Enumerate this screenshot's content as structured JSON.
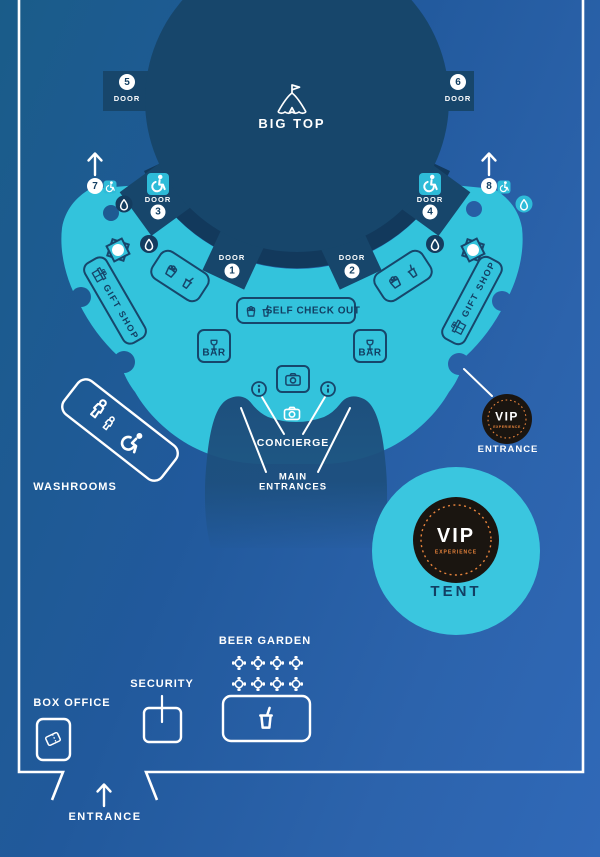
{
  "colors": {
    "background_top_left": "#1a5c89",
    "background_bottom_right": "#3069b8",
    "concourse_teal": "#33c3dc",
    "shape_navy": "#17466b",
    "dark_ring": "#12395c",
    "entrance_arch": "#1d4f7d",
    "accent_orange": "#e8843c",
    "badge_black": "#1a1510",
    "line_white": "#ffffff"
  },
  "big_top": {
    "label": "BIG TOP"
  },
  "doors": [
    {
      "label": "DOOR",
      "number": "1"
    },
    {
      "label": "DOOR",
      "number": "2"
    },
    {
      "label": "DOOR",
      "number": "3",
      "accessible": true
    },
    {
      "label": "DOOR",
      "number": "4",
      "accessible": true
    },
    {
      "label": "DOOR",
      "number": "5"
    },
    {
      "label": "DOOR",
      "number": "6"
    },
    {
      "number": "7",
      "accessible": true
    },
    {
      "number": "8",
      "accessible": true
    }
  ],
  "areas": {
    "self_checkout": "SELF CHECK OUT",
    "bar": "BAR",
    "gift_shop": "GIFT SHOP",
    "concierge": "CONCIERGE",
    "main_entrances_line1": "MAIN",
    "main_entrances_line2": "ENTRANCES",
    "washrooms": "WASHROOMS",
    "beer_garden": "BEER GARDEN",
    "security": "SECURITY",
    "box_office": "BOX OFFICE",
    "entrance": "ENTRANCE"
  },
  "vip": {
    "vip": "VIP",
    "experience": "EXPERIENCE",
    "entrance_label": "ENTRANCE",
    "tent_label": "TENT"
  }
}
